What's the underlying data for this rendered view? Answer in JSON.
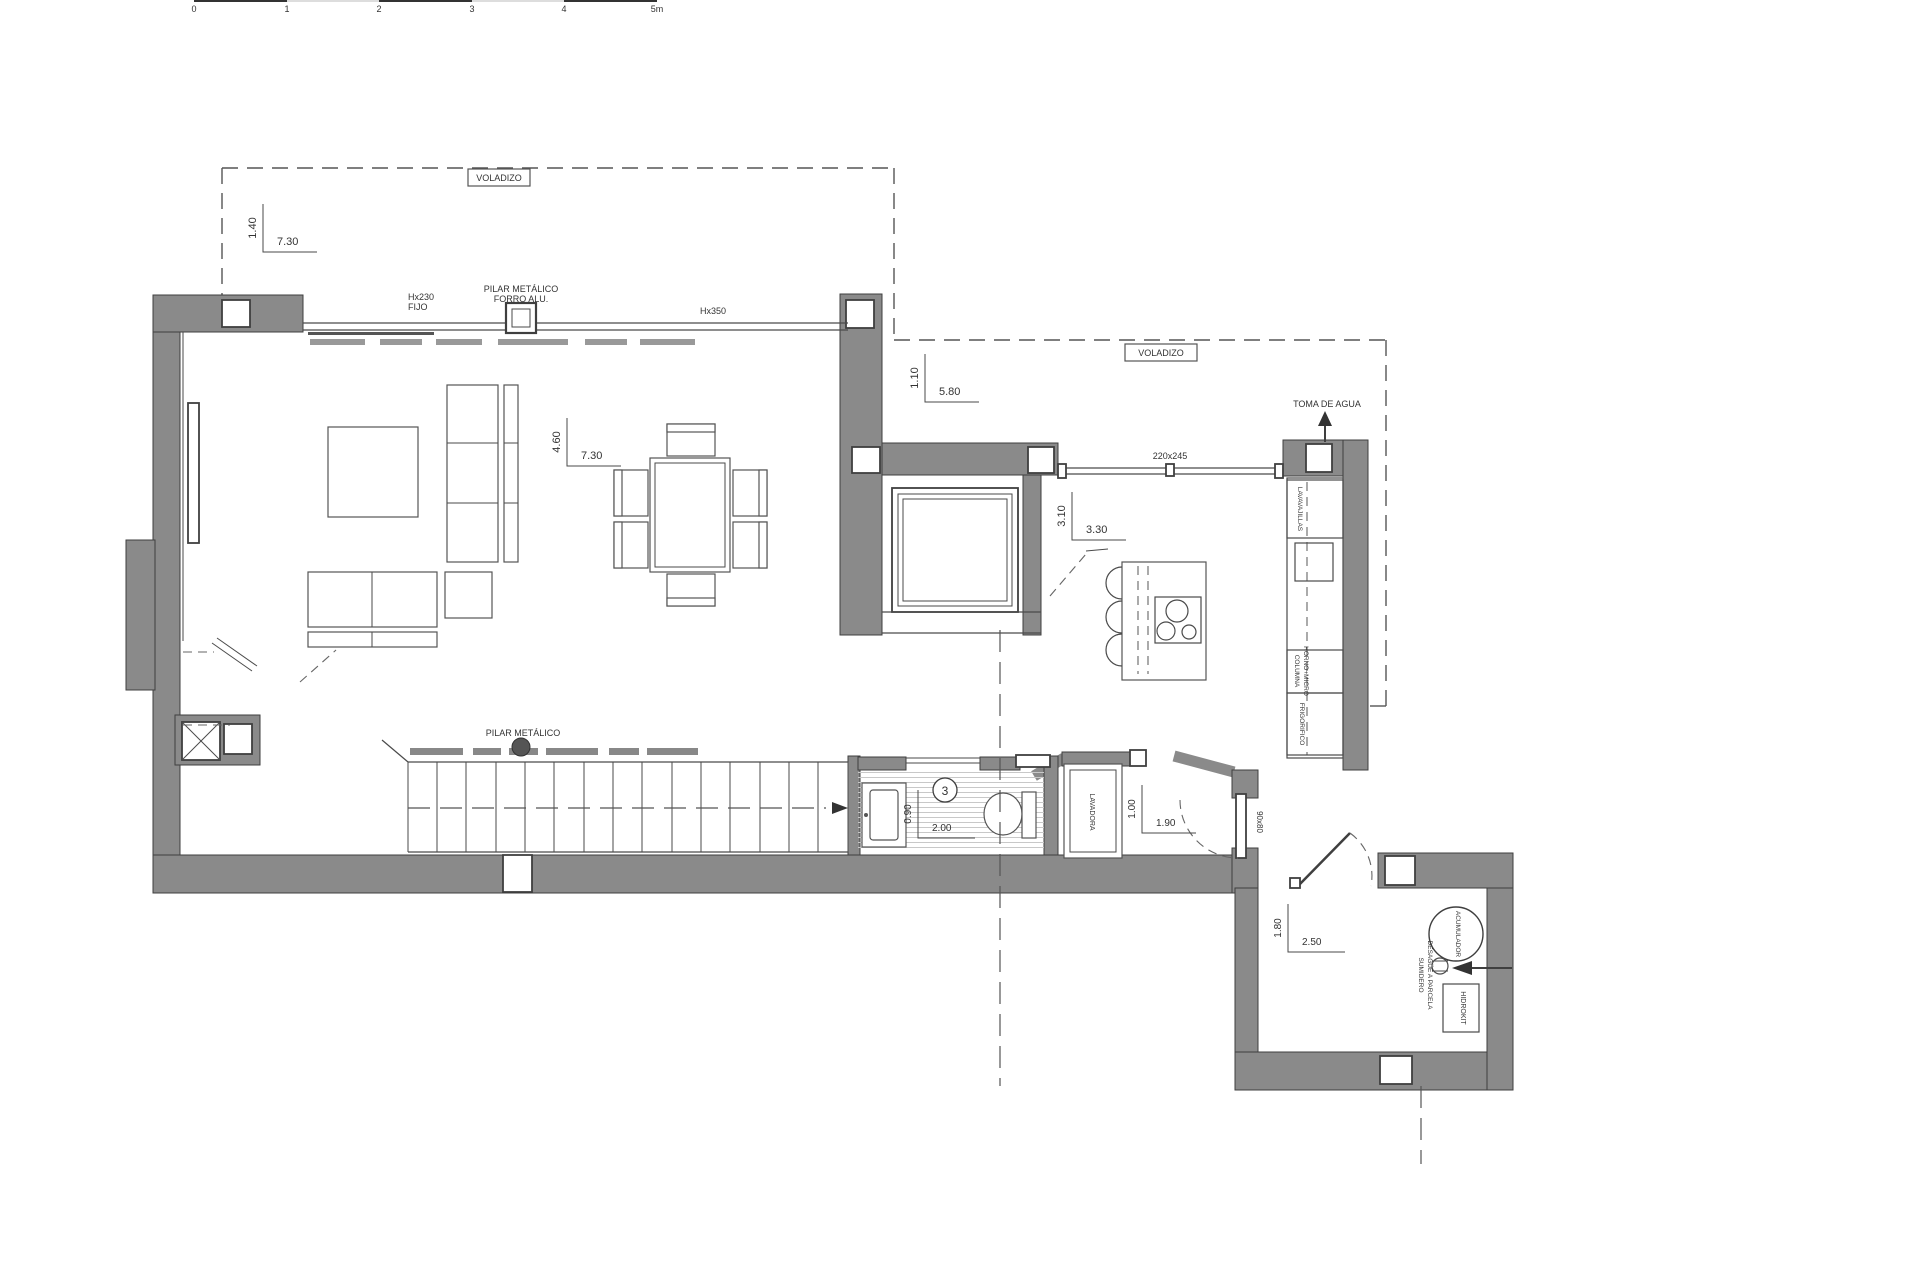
{
  "scale_bar": {
    "labels": [
      "0",
      "1",
      "2",
      "3",
      "4",
      "5m"
    ]
  },
  "annotations": {
    "voladizo": "VOLADIZO",
    "hx230": "Hx230",
    "fijo": "FIJO",
    "pilar_metalico": "PILAR METÁLICO",
    "forro_alu": "FORRO ALU.",
    "hx350": "Hx350",
    "window_size": "220x245",
    "toma_de_agua": "TOMA DE AGUA",
    "door_size": "90x80",
    "room_number": "3"
  },
  "dimensions": {
    "d1": {
      "v": "1.40",
      "h": "7.30"
    },
    "d2": {
      "v": "4.60",
      "h": "7.30"
    },
    "d3": {
      "v": "1.10",
      "h": "5.80"
    },
    "d4": {
      "v": "3.10",
      "h": "3.30"
    },
    "d5": {
      "v": "0.90",
      "h": "2.00"
    },
    "d6": {
      "v": "1.00",
      "h": "1.90"
    },
    "d7": {
      "v": "1.80",
      "h": "2.50"
    }
  },
  "appliances": {
    "lavavajillas": "LAVAVAJILLAS",
    "columna_l1": "COLUMNA",
    "columna_l2": "HORNO+MICRO",
    "frigorifico": "FRIGORIFICO",
    "lavadora": "LAVADORA"
  },
  "utility": {
    "acumulador": "ACUMULADOR",
    "sumidero_l1": "SUMIDERO",
    "sumidero_l2": "DESAGÜE A PARCELA",
    "hidrokit": "HIDROKIT"
  },
  "colors": {
    "wall_gray": "#8a8a8a",
    "line_dark": "#3f3f3f",
    "dash_gray": "#555555",
    "paper": "#ffffff"
  }
}
